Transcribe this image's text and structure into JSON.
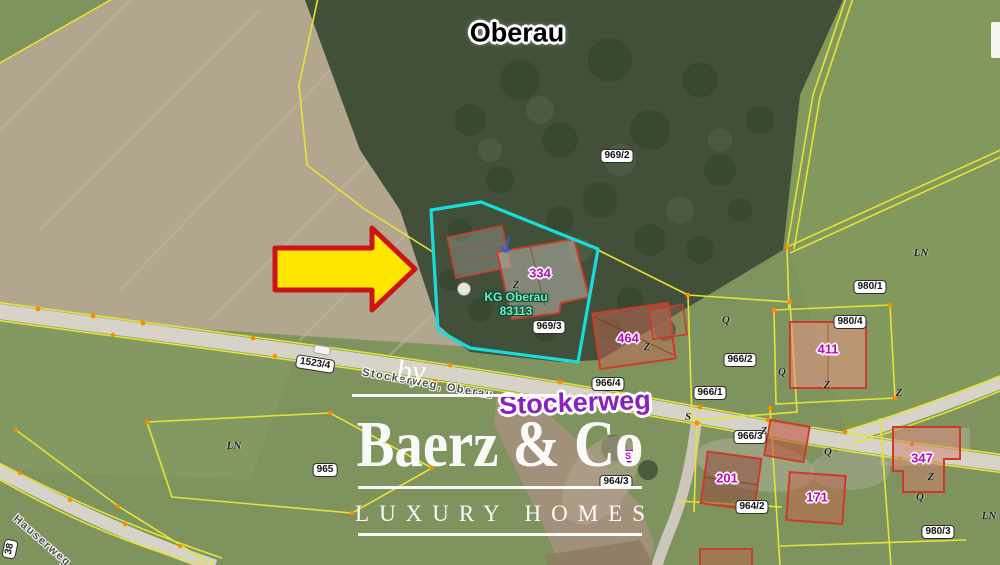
{
  "place": {
    "name": "Oberau"
  },
  "streets": {
    "main": "Stockerweg",
    "along_road": "Stockerweg, Oberau",
    "side": "Hauserweg"
  },
  "cadastre": {
    "community": "KG Oberau",
    "code": "83113"
  },
  "parcels": [
    "969/2",
    "969/3",
    "980/1",
    "980/4",
    "966/2",
    "966/4",
    "966/1",
    "966/3",
    "965",
    "964/3",
    "964/2",
    "980/3",
    "1523/4",
    "38"
  ],
  "buildings": [
    "334",
    "464",
    "411",
    "201",
    "171",
    "347"
  ],
  "symbols": {
    "ln": "LN",
    "q": "Q",
    "z": "Z",
    "s": "S"
  },
  "watermark": {
    "prefix": "by",
    "brand": "Baerz & Co",
    "tagline": "LUXURY HOMES"
  },
  "colors": {
    "highlight": "#17dcdc",
    "arrow_fill": "#ffe600",
    "arrow_border": "#cc1414",
    "parcel_line": "#e4e435",
    "building_outline": "#cf3a28",
    "building_number": "#c400c4",
    "street_highlight": "#8a1fc0",
    "cadastral_text": "#79e9c2"
  }
}
